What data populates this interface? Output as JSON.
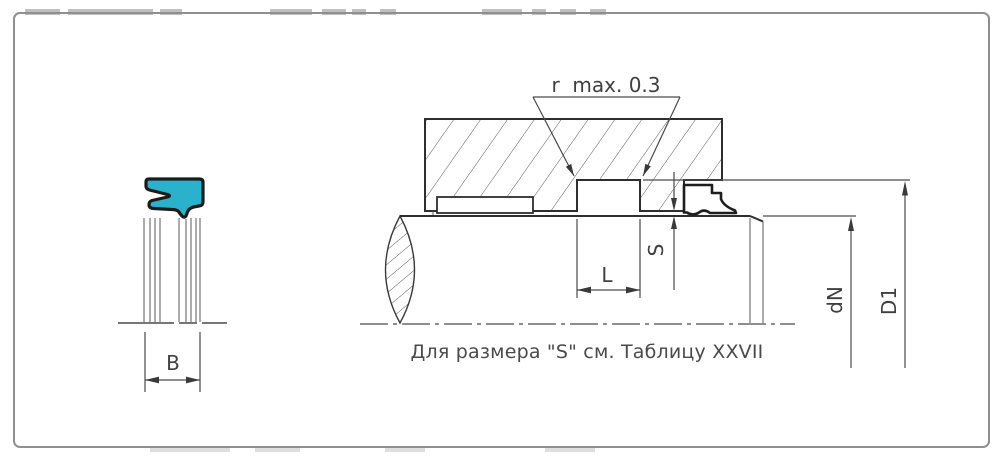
{
  "drawing": {
    "note": "Для размера \"S\" см. Таблицу XXVII",
    "dims": {
      "radius": "r  max. 0.3",
      "groove_width": "L",
      "radial_gap": "S",
      "rod_diameter": "dN",
      "groove_diameter": "D1",
      "seal_width": "B"
    },
    "colors": {
      "seal_fill": "#2ab2cc",
      "seal_outline": "#1b1b1b",
      "line": "#3c3c3c",
      "border": "#8f8f8f"
    }
  }
}
